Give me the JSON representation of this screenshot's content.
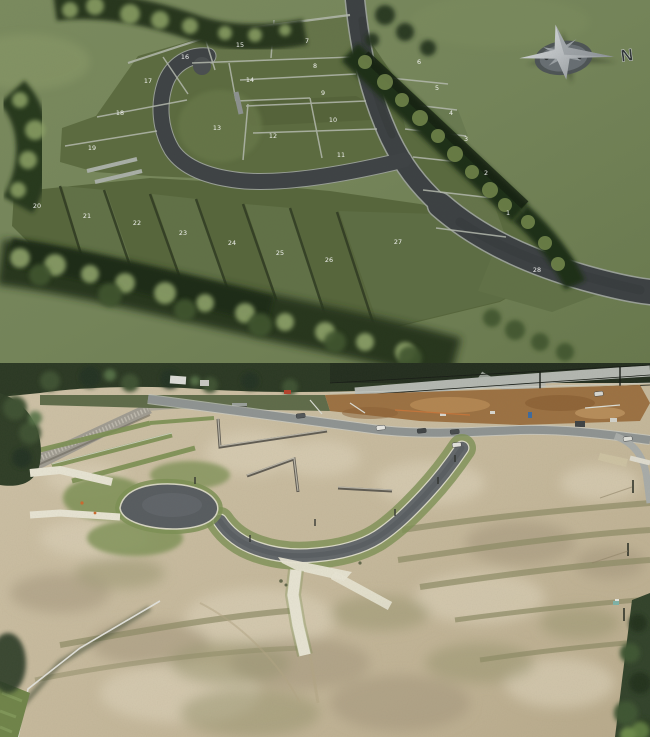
{
  "site_plan": {
    "compass": {
      "label": "N"
    },
    "lots": [
      {
        "num": "1",
        "x": 508,
        "y": 215
      },
      {
        "num": "2",
        "x": 486,
        "y": 175
      },
      {
        "num": "3",
        "x": 466,
        "y": 141
      },
      {
        "num": "4",
        "x": 451,
        "y": 115
      },
      {
        "num": "5",
        "x": 437,
        "y": 90
      },
      {
        "num": "6",
        "x": 419,
        "y": 64
      },
      {
        "num": "7",
        "x": 307,
        "y": 43
      },
      {
        "num": "8",
        "x": 315,
        "y": 68
      },
      {
        "num": "9",
        "x": 323,
        "y": 95
      },
      {
        "num": "10",
        "x": 333,
        "y": 122
      },
      {
        "num": "11",
        "x": 341,
        "y": 157
      },
      {
        "num": "12",
        "x": 273,
        "y": 138
      },
      {
        "num": "13",
        "x": 217,
        "y": 130
      },
      {
        "num": "14",
        "x": 250,
        "y": 82
      },
      {
        "num": "15",
        "x": 240,
        "y": 47
      },
      {
        "num": "16",
        "x": 185,
        "y": 59
      },
      {
        "num": "17",
        "x": 148,
        "y": 83
      },
      {
        "num": "18",
        "x": 120,
        "y": 115
      },
      {
        "num": "19",
        "x": 92,
        "y": 150
      },
      {
        "num": "20",
        "x": 37,
        "y": 208
      },
      {
        "num": "21",
        "x": 87,
        "y": 218
      },
      {
        "num": "22",
        "x": 137,
        "y": 225
      },
      {
        "num": "23",
        "x": 183,
        "y": 235
      },
      {
        "num": "24",
        "x": 232,
        "y": 245
      },
      {
        "num": "25",
        "x": 280,
        "y": 255
      },
      {
        "num": "26",
        "x": 329,
        "y": 262
      },
      {
        "num": "27",
        "x": 398,
        "y": 244
      },
      {
        "num": "28",
        "x": 537,
        "y": 272
      }
    ],
    "palette": {
      "background_green": "#75855a",
      "lot_green": "#5c6b40",
      "road_asphalt": "#3c4043",
      "curb_gray": "#9aa098",
      "tree_dark": "#26351d",
      "compass_silver": "#c9ccd0"
    }
  },
  "aerial_photo": {
    "vehicles": [
      {
        "x": 376,
        "y": 63,
        "c": "#e8e8e3"
      },
      {
        "x": 417,
        "y": 66,
        "c": "#3f4446"
      },
      {
        "x": 450,
        "y": 67,
        "c": "#474c4e"
      },
      {
        "x": 452,
        "y": 80,
        "c": "#e4e4df"
      },
      {
        "x": 623,
        "y": 74,
        "c": "#dfe0da"
      },
      {
        "x": 296,
        "y": 51,
        "c": "#52575a"
      },
      {
        "x": 594,
        "y": 29,
        "c": "#d8d8d2"
      }
    ],
    "palette": {
      "dirt_tan": "#c6b99c",
      "asphalt": "#62676b",
      "concrete": "#e8e5d4",
      "grass_verge": "#7d9155",
      "trees": "#2a3823",
      "construction_dirt": "#9c7142",
      "stone_wall": "#6e6a60"
    }
  }
}
